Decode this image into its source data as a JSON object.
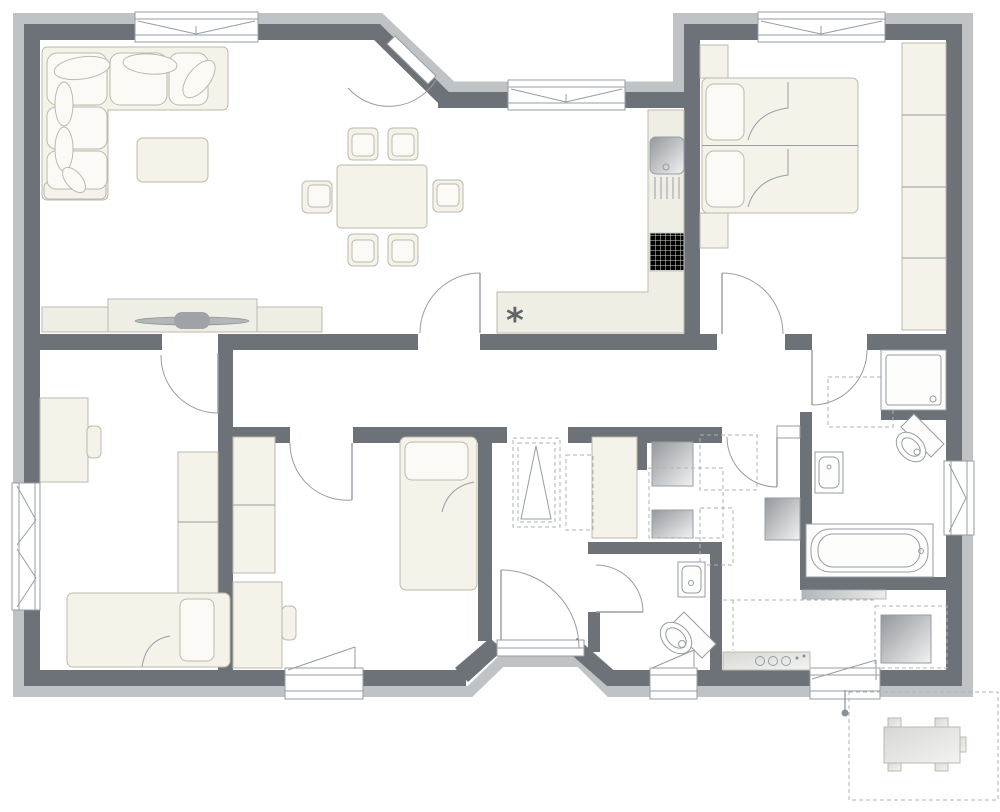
{
  "title": "apartment-floor-plan",
  "palette": {
    "wall": "#6c7278",
    "band": "#bfc3c6",
    "furn": "#f4f2e9",
    "furnStroke": "#bdbaab",
    "counter": "#efeee5",
    "line": "#979da2",
    "dash": "#aeb3b6",
    "drain": "#8a9094"
  },
  "symbols": {
    "cooktop_marker": "*"
  },
  "rooms": {
    "living_room": {
      "furniture": [
        "corner-sofa",
        "coffee-table",
        "tv-sideboard",
        "tv"
      ]
    },
    "dining_area": {
      "furniture": [
        "dining-table",
        "dining-chairs-x6"
      ]
    },
    "kitchen": {
      "furniture": [
        "l-counter",
        "sink",
        "drainboard",
        "cooktop",
        "cooktop-marker"
      ]
    },
    "bedroom": {
      "furniture": [
        "double-bed",
        "pillows-x2",
        "nightstand-x2",
        "wardrobe-4-sections"
      ]
    },
    "room_left": {
      "furniture": [
        "desk",
        "chair",
        "wardrobe-2-sections",
        "single-bed"
      ]
    },
    "room_middle": {
      "furniture": [
        "wardrobe-2-sections",
        "desk",
        "chair",
        "single-bed"
      ]
    },
    "entrance_hall": {
      "furniture": [
        "dashed-planned-wardrobe",
        "front-door"
      ]
    },
    "utility_nook": {
      "furniture": [
        "tall-cabinet",
        "washer",
        "dryer"
      ]
    },
    "guest_wc": {
      "furniture": [
        "washbasin",
        "toilet",
        "window"
      ]
    },
    "corridor": {
      "furniture": [
        "water-heater"
      ]
    },
    "bathroom": {
      "furniture": [
        "shower",
        "toilet",
        "washbasin",
        "bathtub",
        "radiator",
        "window"
      ]
    },
    "tech_room": {
      "furniture": [
        "boiler",
        "counter-unit-with-knobs",
        "window"
      ]
    },
    "terrace": {
      "furniture": [
        "garden-table",
        "drain-point"
      ]
    }
  },
  "windows": [
    "living-top",
    "kitchen-top",
    "bedroom-top",
    "bathroom-right",
    "room-left-west",
    "room-left-south",
    "wc-south",
    "tech-south"
  ],
  "doors": [
    "terrace-diagonal-door",
    "living-to-room-left",
    "dining-to-hallway",
    "room-middle-door",
    "bedroom-door",
    "bathroom-door",
    "corridor-door",
    "wc-door",
    "front-door"
  ]
}
